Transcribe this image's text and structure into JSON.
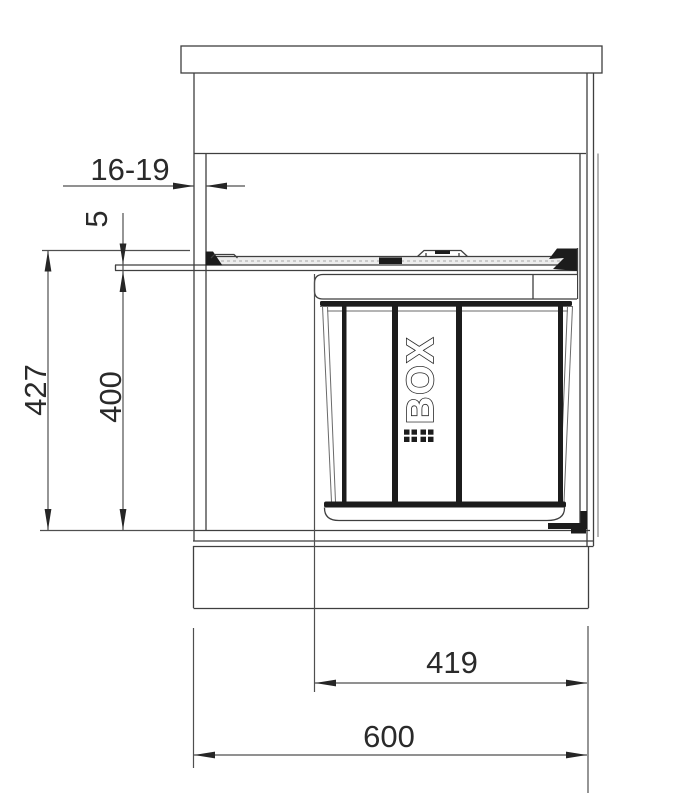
{
  "drawing": {
    "type": "cabinet-waste-bin-cross-section",
    "bin": {
      "brand": "BOX",
      "logo_icon": "double-square-grid-icon"
    },
    "dims": {
      "front_thickness": "16-19",
      "rail_height": "5",
      "total_height": "427",
      "bin_height": "400",
      "bin_width": "419",
      "cabinet_width": "600"
    },
    "colors": {
      "line": "#3f3f3f",
      "dark_fill": "#1c1c1c",
      "background": "#ffffff"
    }
  }
}
